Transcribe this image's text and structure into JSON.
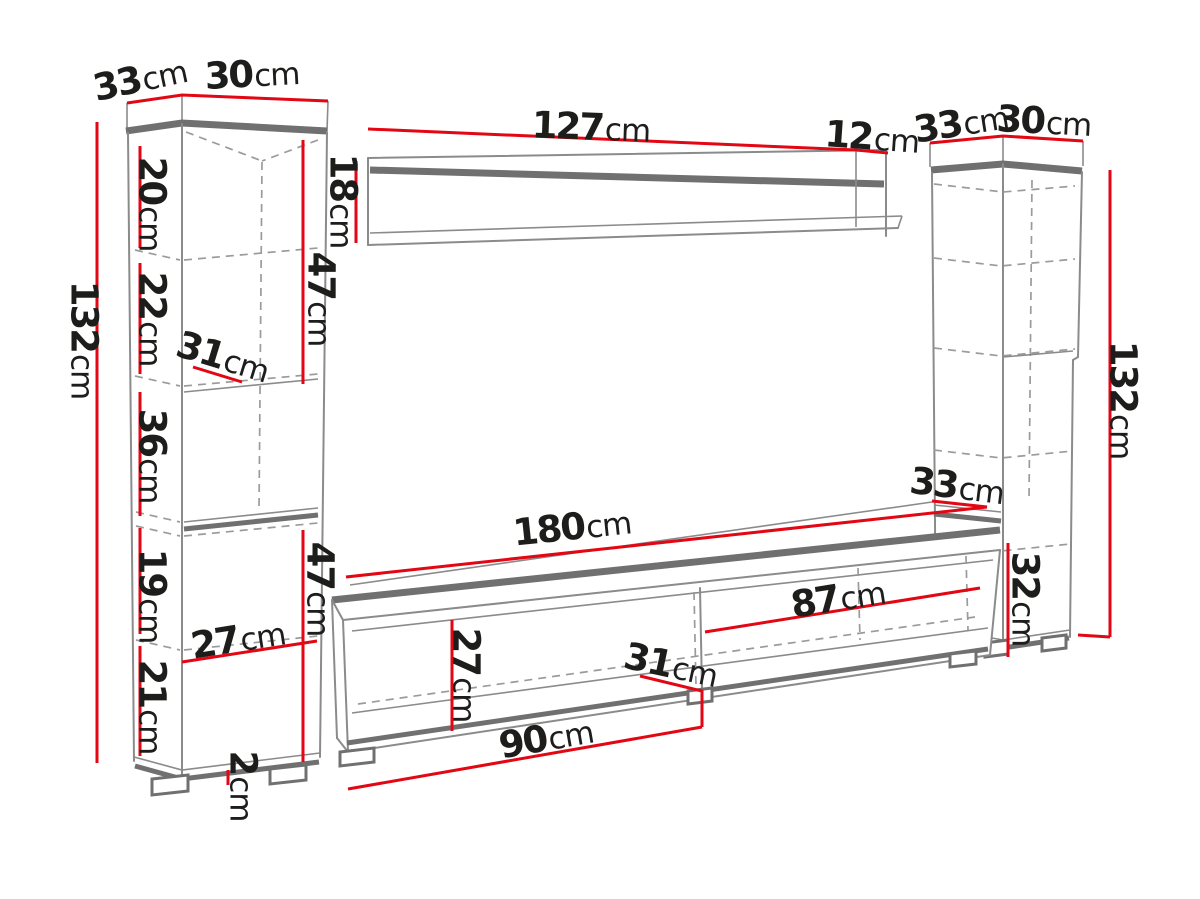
{
  "title": "Wall unit furniture dimensions diagram",
  "unit": "cm",
  "colors": {
    "dimension_red": "#e30613",
    "outline_gray": "#8b8b8b",
    "panel_gray": "#707070",
    "dash_gray": "#9b9b9b",
    "text": "#1d1d1b",
    "background": "#ffffff"
  },
  "dims": {
    "left_cabinet": {
      "depth": {
        "v": "33",
        "u": "cm"
      },
      "width": {
        "v": "30",
        "u": "cm"
      },
      "height": {
        "v": "132",
        "u": "cm"
      },
      "shelf_top": {
        "v": "20",
        "u": "cm"
      },
      "shelf_second": {
        "v": "22",
        "u": "cm"
      },
      "upper_section": {
        "v": "47",
        "u": "cm"
      },
      "shelf_depth": {
        "v": "31",
        "u": "cm"
      },
      "open_niche": {
        "v": "36",
        "u": "cm"
      },
      "shelf_fourth": {
        "v": "19",
        "u": "cm"
      },
      "inner_width": {
        "v": "27",
        "u": "cm"
      },
      "shelf_bottom": {
        "v": "21",
        "u": "cm"
      },
      "lower_section": {
        "v": "47",
        "u": "cm"
      },
      "foot_height": {
        "v": "2",
        "u": "cm"
      }
    },
    "wall_shelf": {
      "width": {
        "v": "127",
        "u": "cm"
      },
      "depth": {
        "v": "12",
        "u": "cm"
      },
      "height": {
        "v": "18",
        "u": "cm"
      }
    },
    "right_cabinet": {
      "depth": {
        "v": "33",
        "u": "cm"
      },
      "width": {
        "v": "30",
        "u": "cm"
      },
      "height": {
        "v": "132",
        "u": "cm"
      },
      "niche_depth": {
        "v": "33",
        "u": "cm"
      },
      "bottom_section": {
        "v": "32",
        "u": "cm"
      }
    },
    "tv_stand": {
      "width": {
        "v": "180",
        "u": "cm"
      },
      "right_compartment": {
        "v": "87",
        "u": "cm"
      },
      "inner_height": {
        "v": "27",
        "u": "cm"
      },
      "divider_depth": {
        "v": "31",
        "u": "cm"
      },
      "left_compartment": {
        "v": "90",
        "u": "cm"
      }
    }
  }
}
